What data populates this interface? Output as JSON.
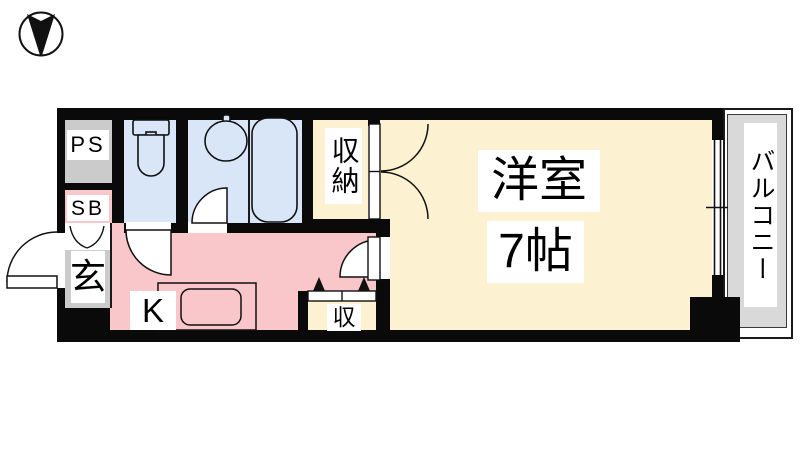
{
  "document_type": "apartment floor plan",
  "compass": {
    "icon": "north-arrow"
  },
  "labels": {
    "ps": "PS",
    "sb": "SB",
    "entrance": "玄",
    "kitchen": "K",
    "closet": "収納",
    "storage": "収",
    "room_name": "洋室",
    "room_size": "7帖",
    "balcony": "バルコニー"
  },
  "colors": {
    "wall": "#0a0a0a",
    "wet_area": "#d9e6f8",
    "kitchen_area": "#f9c6ca",
    "room_area": "#fcf2d2",
    "service_area": "#cbcbcb",
    "balcony_area": "#d9d9d9",
    "label_background": "#ffffff",
    "text": "#000000"
  }
}
